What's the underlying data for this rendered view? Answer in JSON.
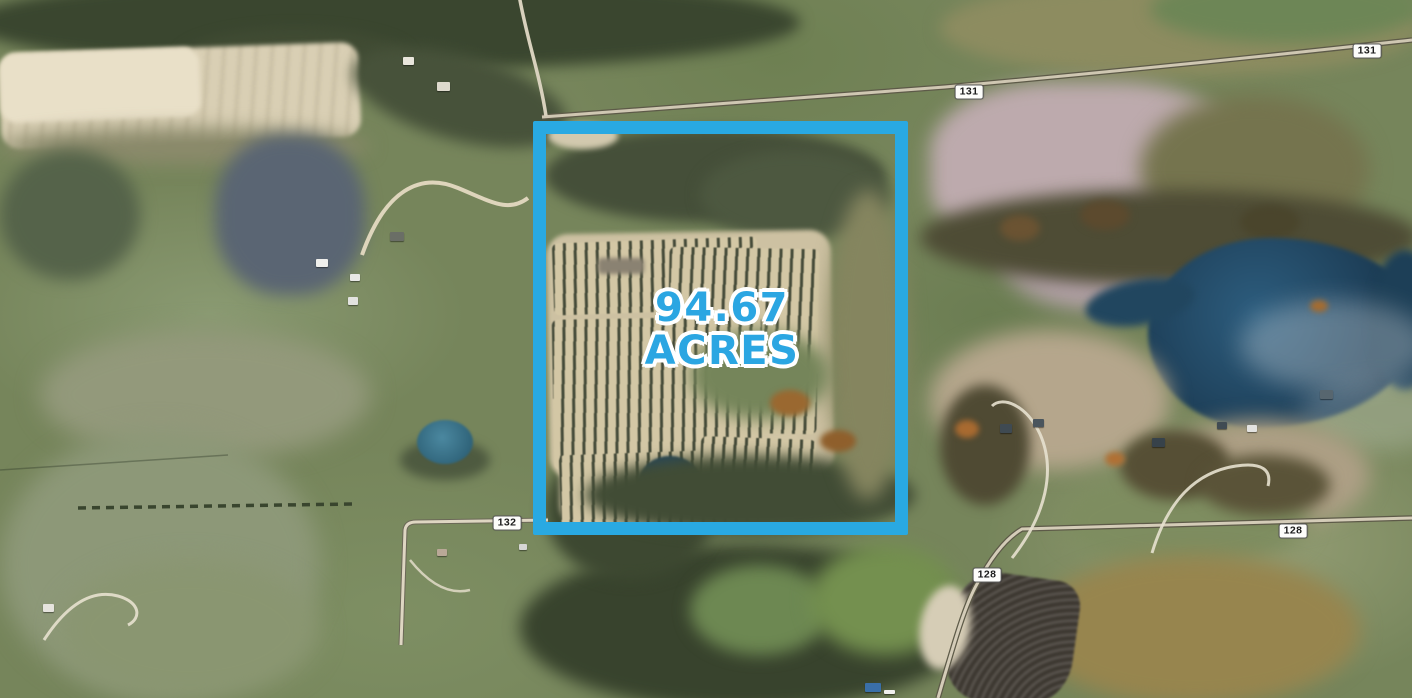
{
  "boundary": {
    "color": "#29A9E2",
    "acreage_line1": "94.67",
    "acreage_line2": "ACRES",
    "text_color": "#2BA6E2"
  },
  "road_labels": {
    "items": [
      {
        "text": "131"
      },
      {
        "text": "131"
      },
      {
        "text": "132"
      },
      {
        "text": "128"
      },
      {
        "text": "128"
      }
    ]
  }
}
